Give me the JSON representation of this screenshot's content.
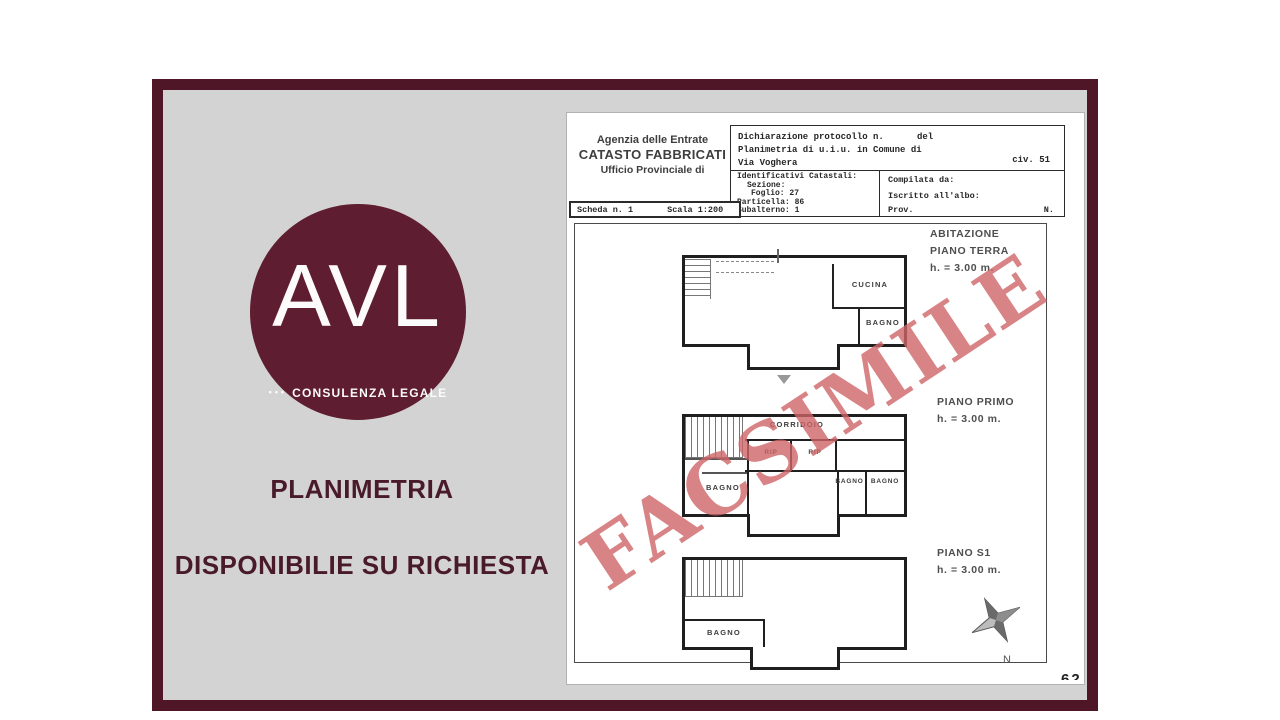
{
  "left_panel": {
    "logo": {
      "acronym": "AVL",
      "dots": "•••",
      "tagline": "CONSULENZA LEGALE"
    },
    "title": "PLANIMETRIA",
    "subtitle": "DISPONIBILIE SU RICHIESTA"
  },
  "document": {
    "agency": {
      "line1": "Agenzia delle Entrate",
      "line2": "CATASTO FABBRICATI",
      "line3": "Ufficio Provinciale di"
    },
    "declaration": {
      "protocol": "Dichiarazione protocollo n.",
      "del": "del",
      "planimetria": "Planimetria di u.i.u. in Comune di",
      "street": "Via Voghera",
      "civ": "civ. 51"
    },
    "identifiers": {
      "title": "Identificativi Catastali:",
      "sezione": "Sezione:",
      "foglio": "Foglio: 27",
      "particella": "Particella: 86",
      "subalterno": "Subalterno: 1"
    },
    "compiler": {
      "compilata": "Compilata da:",
      "iscritto": "Iscritto all'albo:",
      "prov": "Prov.",
      "n": "N."
    },
    "scheda": {
      "label": "Scheda n. 1",
      "scala": "Scala 1:200"
    },
    "watermark": "FACSIMILE",
    "floor_labels": [
      {
        "line1": "ABITAZIONE",
        "line2": "PIANO TERRA",
        "height": "h. = 3.00 m."
      },
      {
        "line1": "PIANO PRIMO",
        "line2": "",
        "height": "h. = 3.00 m."
      },
      {
        "line1": "PIANO S1",
        "line2": "",
        "height": "h. = 3.00 m."
      }
    ],
    "rooms": {
      "ground_cucina": "CUCINA",
      "ground_bagno": "BAGNO",
      "first_corridoio": "CORRIDOIO",
      "first_rip1": "RIP",
      "first_rip2": "RIP",
      "first_bagno_left": "BAGNO",
      "first_bagno_right1": "BAGNO",
      "first_bagno_right2": "BAGNO",
      "s1_bagno": "BAGNO"
    },
    "compass": "N",
    "page_number_fragment": "62"
  },
  "colors": {
    "frame": "#4f1627",
    "logo_circle": "#5e1d30",
    "heading_text": "#491a29",
    "watermark": "#ce6466",
    "panel_background": "#d4d3d3"
  }
}
